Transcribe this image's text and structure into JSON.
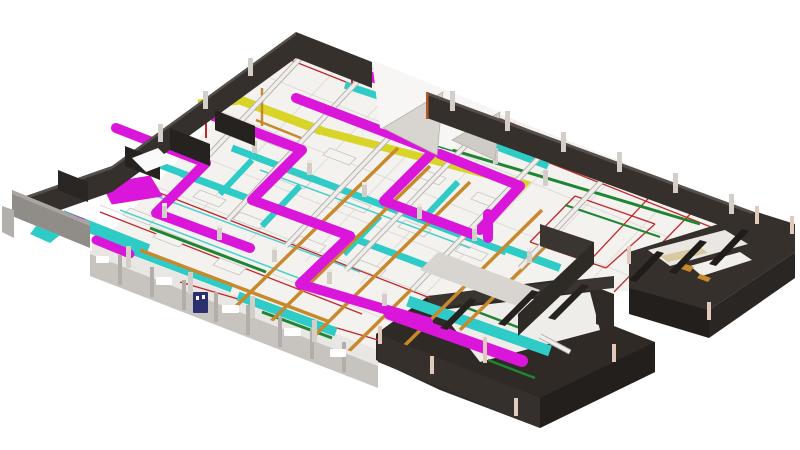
{
  "scene": {
    "kind": "3d-bim-mep-model-render",
    "view": "isometric-floor-plate",
    "background": "#ffffff"
  },
  "palette": {
    "floor": "#f3f2ef",
    "grid_line": "#dfdcd8",
    "wall_dark": "#36302c",
    "wall_dark_shadow": "#221f1c",
    "wall_light": "#c7c3bf",
    "wall_light_top": "#e9e7e3",
    "soffit_gray": "#d8d5d1",
    "column": "#d3cec7",
    "column_cap": "#ece8e1",
    "column_warm": "#e2c9bb",
    "equipment_white": "#f5f3f0",
    "beam_white": "#f0eeea",
    "beam_shadow": "#b6b3af",
    "door_navy": "#2a3070",
    "dock_gray": "#908c87"
  },
  "layers": [
    {
      "id": "supply-ductwork",
      "color": "#d916d9"
    },
    {
      "id": "return-ductwork",
      "color": "#2fcbc7"
    },
    {
      "id": "heating-pipework",
      "color": "#c8892c"
    },
    {
      "id": "exhaust-ductwork",
      "color": "#d8d428"
    },
    {
      "id": "electrical-conduit",
      "color": "#1f8434"
    },
    {
      "id": "fire-sprinkler-lines",
      "color": "#c1272d"
    }
  ]
}
